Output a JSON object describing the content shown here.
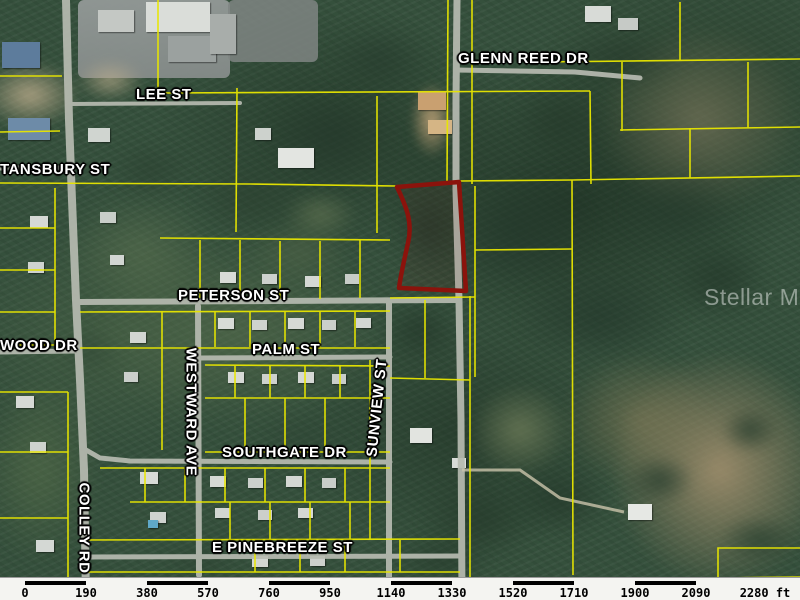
{
  "map": {
    "watermark": {
      "text": "Stellar MLS"
    },
    "colors": {
      "parcel_line": "#e8e600",
      "highlighted_parcel": "#8b130c",
      "road": "#b7bbb1"
    },
    "streets": [
      {
        "name": "GLENN REED DR"
      },
      {
        "name": "LEE ST"
      },
      {
        "name": "TANSBURY ST"
      },
      {
        "name": "PETERSON ST"
      },
      {
        "name": "WOOD DR"
      },
      {
        "name": "PALM ST"
      },
      {
        "name": "WESTWARD AVE"
      },
      {
        "name": "SUNVIEW ST"
      },
      {
        "name": "SOUTHGATE DR"
      },
      {
        "name": "COLLEY RD"
      },
      {
        "name": "E PINEBREEZE ST"
      }
    ],
    "scale_bar": {
      "unit": "ft",
      "labels": [
        "0",
        "190",
        "380",
        "570",
        "760",
        "950",
        "1140",
        "1330",
        "1520",
        "1710",
        "1900",
        "2090",
        "2280 ft"
      ]
    }
  }
}
